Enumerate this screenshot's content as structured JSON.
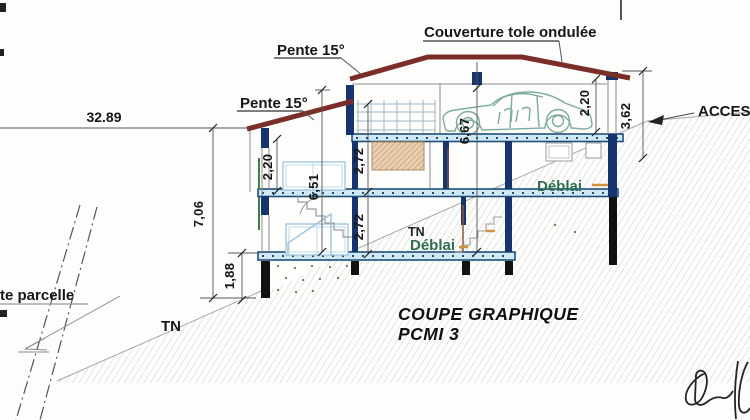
{
  "meta": {
    "drawing_type": "architectural section",
    "canvas": "750x420"
  },
  "title": {
    "line1": "COUPE GRAPHIQUE",
    "line2": "PCMI 3"
  },
  "labels": {
    "roof_cover": "Couverture tole ondulée",
    "slope_upper": "Pente 15°",
    "slope_lower": "Pente 15°",
    "access": "ACCES",
    "parcel_limit": "te parcelle",
    "tn_left": "TN",
    "tn_mid": "TN",
    "deblai_upper": "Déblai",
    "deblai_lower": "Déblai"
  },
  "dimensions": {
    "total_width": "32.89",
    "left_overall_height": "7,06",
    "footing_height": "1,88",
    "left_storey_height": "2,20",
    "left_total_height": "6,51",
    "mid_storey_upper": "2,72",
    "mid_storey_lower": "2,72",
    "center_total_height": "6,67",
    "garage_height": "2,20",
    "access_drop": "3,62"
  },
  "colors": {
    "roof": "#7b2d28",
    "slab_edge": "#1e4e79",
    "slab_fill": "#cfe8f3",
    "column_navy": "#16356e",
    "pile_black": "#111111",
    "deblai_green": "#2e6e52",
    "accent_orange": "#d4913f",
    "car_outline": "#7fab9e",
    "terrain_hatch": "#cccccc"
  }
}
